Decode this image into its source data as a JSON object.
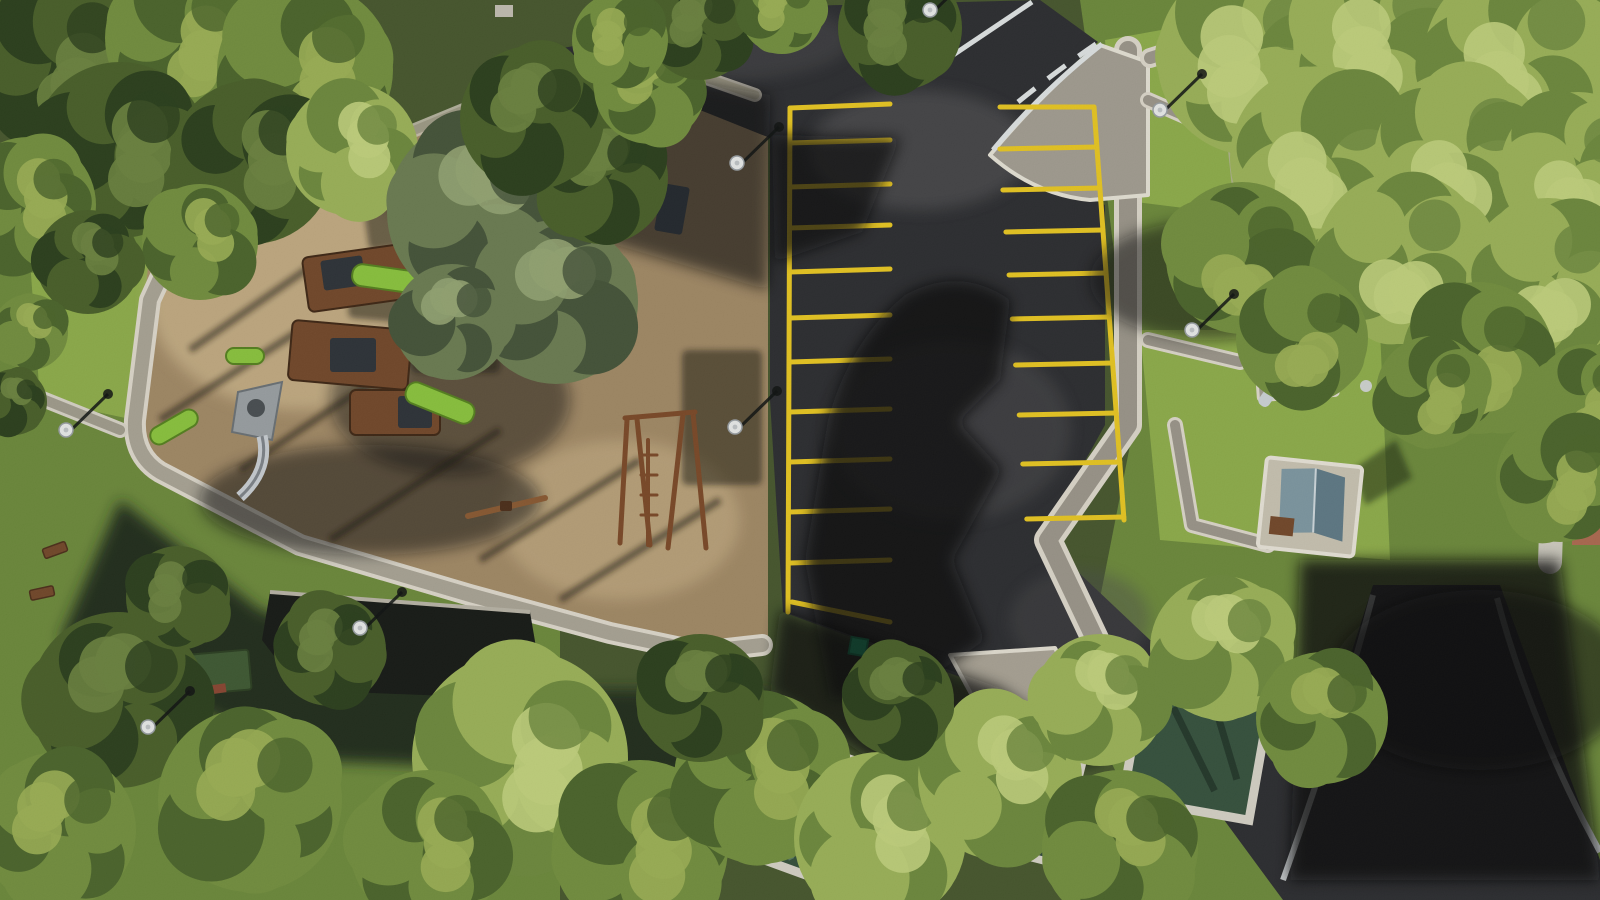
{
  "scene": {
    "kind": "aerial-drone-photograph",
    "subject": "public park seen from directly above: sandy playground with wooden play structures and swings on the left, freshly paved asphalt parking lot with yellow bay markings in the centre, lawns with paved white-edged walkways, picnic kiosks and covered sunken pools on the right and bottom, dense pine/cedar canopy all around",
    "lighting": "low sun from lower-left; long hard shadows point to the upper-right; large tree shadows fall across the parking lot"
  },
  "colors": {
    "sand": "#a28a66",
    "sand_light": "#c2ab82",
    "asphalt": "#2d2e31",
    "asphalt_light": "#4b4c4e",
    "grass": "#6d8a3c",
    "grass_bright": "#8fae4b",
    "grass_dark": "#3c5226",
    "path_gray": "#a59f90",
    "path_white": "#e6e2d6",
    "line_yellow": "#e9c722",
    "line_white": "#dfe3e4",
    "wood": "#74492a",
    "wood_dark": "#4d2f1a",
    "slide_green": "#8bc43e",
    "roof_blue": "#9db3bf",
    "roof_blue_dark": "#5f7a86",
    "shadow": "#0b0d10",
    "pool_cover": "#34503c",
    "pool_cover_light": "#7d98a2",
    "red_roof": "#ad6a50"
  },
  "parking_lot": {
    "surface": "new black asphalt",
    "left_column": {
      "spine": [
        790,
        108,
        788,
        612
      ],
      "tooth_end_x": 890,
      "tooth_ys": [
        143,
        187,
        228,
        272,
        318,
        362,
        412,
        462,
        512,
        563
      ],
      "top_line": [
        790,
        108,
        890,
        104
      ],
      "bottom_line": [
        792,
        602,
        890,
        622
      ],
      "bay_count": 10
    },
    "right_column": {
      "spine": [
        1094,
        107,
        1124,
        520
      ],
      "tooth_length": 97,
      "tooth_ys": [
        147,
        188,
        230,
        273,
        317,
        363,
        413,
        462,
        517
      ],
      "top_line": [
        1000,
        107,
        1094,
        107
      ],
      "bay_count": 9
    }
  },
  "trees": [
    {
      "x": 60,
      "y": 60,
      "r": 85,
      "tone": "dark"
    },
    {
      "x": 185,
      "y": 38,
      "r": 80,
      "tone": "mid"
    },
    {
      "x": 305,
      "y": 70,
      "r": 88,
      "tone": "mid"
    },
    {
      "x": 120,
      "y": 150,
      "r": 88,
      "tone": "dark"
    },
    {
      "x": 252,
      "y": 162,
      "r": 82,
      "tone": "dark"
    },
    {
      "x": 28,
      "y": 205,
      "r": 68,
      "tone": "mid"
    },
    {
      "x": 352,
      "y": 150,
      "r": 66,
      "tone": "bright"
    },
    {
      "x": 200,
      "y": 242,
      "r": 58,
      "tone": "mid"
    },
    {
      "x": 88,
      "y": 262,
      "r": 52,
      "tone": "dark"
    },
    {
      "x": 30,
      "y": 332,
      "r": 38,
      "tone": "mid"
    },
    {
      "x": 14,
      "y": 402,
      "r": 33,
      "tone": "dark"
    },
    {
      "x": 482,
      "y": 212,
      "r": 95,
      "tone": "cedar"
    },
    {
      "x": 556,
      "y": 302,
      "r": 82,
      "tone": "cedar"
    },
    {
      "x": 452,
      "y": 322,
      "r": 58,
      "tone": "cedar"
    },
    {
      "x": 602,
      "y": 178,
      "r": 66,
      "tone": "dark"
    },
    {
      "x": 532,
      "y": 118,
      "r": 72,
      "tone": "dark"
    },
    {
      "x": 650,
      "y": 88,
      "r": 56,
      "tone": "mid"
    },
    {
      "x": 700,
      "y": 28,
      "r": 52,
      "tone": "dark"
    },
    {
      "x": 782,
      "y": 12,
      "r": 42,
      "tone": "mid"
    },
    {
      "x": 620,
      "y": 40,
      "r": 48,
      "tone": "mid"
    },
    {
      "x": 900,
      "y": 28,
      "r": 62,
      "tone": "dark"
    },
    {
      "x": 1255,
      "y": 58,
      "r": 98,
      "tone": "bright"
    },
    {
      "x": 1385,
      "y": 40,
      "r": 92,
      "tone": "bright"
    },
    {
      "x": 1520,
      "y": 58,
      "r": 96,
      "tone": "bright"
    },
    {
      "x": 1322,
      "y": 158,
      "r": 92,
      "tone": "bright"
    },
    {
      "x": 1462,
      "y": 158,
      "r": 88,
      "tone": "bright"
    },
    {
      "x": 1578,
      "y": 170,
      "r": 78,
      "tone": "bright"
    },
    {
      "x": 1242,
      "y": 258,
      "r": 76,
      "tone": "mid"
    },
    {
      "x": 1402,
      "y": 258,
      "r": 86,
      "tone": "bright"
    },
    {
      "x": 1548,
      "y": 280,
      "r": 82,
      "tone": "bright"
    },
    {
      "x": 1302,
      "y": 338,
      "r": 66,
      "tone": "mid"
    },
    {
      "x": 1478,
      "y": 358,
      "r": 76,
      "tone": "mid"
    },
    {
      "x": 1588,
      "y": 400,
      "r": 56,
      "tone": "mid"
    },
    {
      "x": 1432,
      "y": 392,
      "r": 56,
      "tone": "mid"
    },
    {
      "x": 1560,
      "y": 478,
      "r": 64,
      "tone": "mid"
    },
    {
      "x": 520,
      "y": 758,
      "r": 108,
      "tone": "bright"
    },
    {
      "x": 640,
      "y": 848,
      "r": 88,
      "tone": "mid"
    },
    {
      "x": 428,
      "y": 848,
      "r": 78,
      "tone": "mid"
    },
    {
      "x": 760,
      "y": 778,
      "r": 86,
      "tone": "mid"
    },
    {
      "x": 880,
      "y": 838,
      "r": 86,
      "tone": "bright"
    },
    {
      "x": 1000,
      "y": 778,
      "r": 82,
      "tone": "bright"
    },
    {
      "x": 1120,
      "y": 848,
      "r": 78,
      "tone": "mid"
    },
    {
      "x": 1100,
      "y": 700,
      "r": 66,
      "tone": "bright"
    },
    {
      "x": 1222,
      "y": 648,
      "r": 72,
      "tone": "bright"
    },
    {
      "x": 1322,
      "y": 718,
      "r": 66,
      "tone": "mid"
    },
    {
      "x": 898,
      "y": 700,
      "r": 56,
      "tone": "dark"
    },
    {
      "x": 700,
      "y": 698,
      "r": 64,
      "tone": "dark"
    },
    {
      "x": 118,
      "y": 700,
      "r": 88,
      "tone": "dark"
    },
    {
      "x": 250,
      "y": 800,
      "r": 92,
      "tone": "mid"
    },
    {
      "x": 58,
      "y": 830,
      "r": 78,
      "tone": "mid"
    },
    {
      "x": 330,
      "y": 650,
      "r": 56,
      "tone": "dark"
    },
    {
      "x": 178,
      "y": 598,
      "r": 52,
      "tone": "dark"
    }
  ],
  "tree_tones": {
    "bright": [
      "#c2d17d",
      "#9cb359",
      "#6e8a3e"
    ],
    "mid": [
      "#9db155",
      "#74903f",
      "#4c662c"
    ],
    "dark": [
      "#6d8440",
      "#4a6029",
      "#2c401d"
    ],
    "cedar": [
      "#95a573",
      "#6c7d52",
      "#45543a"
    ]
  },
  "lamps": [
    {
      "x": 66,
      "y": 430
    },
    {
      "x": 737,
      "y": 163
    },
    {
      "x": 735,
      "y": 427
    },
    {
      "x": 360,
      "y": 628
    },
    {
      "x": 148,
      "y": 727
    },
    {
      "x": 1160,
      "y": 110
    },
    {
      "x": 1192,
      "y": 330
    },
    {
      "x": 930,
      "y": 10
    }
  ],
  "benches": [
    {
      "x": 55,
      "y": 550,
      "rot": -20
    },
    {
      "x": 42,
      "y": 593,
      "rot": -12
    },
    {
      "x": 168,
      "y": 605,
      "rot": 6
    }
  ],
  "pool_enclosures": [
    {
      "cx": 800,
      "cy": 807,
      "w": 124,
      "h": 124,
      "rot": 20,
      "cover": "dark-green"
    },
    {
      "cx": 1020,
      "cy": 798,
      "w": 104,
      "h": 110,
      "rot": 14,
      "cover": "light-tarp"
    },
    {
      "cx": 1196,
      "cy": 752,
      "w": 128,
      "h": 116,
      "rot": 10,
      "cover": "dark-green"
    }
  ],
  "kiosks": [
    {
      "name": "kiosk-blue-roof-north",
      "x": 1268,
      "y": 142
    },
    {
      "name": "picnic-shelter-northeast",
      "x": 1520,
      "y": 140
    },
    {
      "name": "picnic-table-east",
      "x": 1295,
      "y": 365
    },
    {
      "name": "kiosk-blue-roof-east",
      "x": 1310,
      "y": 505
    }
  ],
  "playground": {
    "ground": "tan sand",
    "equipment": [
      "wooden multi-tower play structure with green slides",
      "steel spiral slide on grey triangular platform",
      "double swing set",
      "see-saw",
      "climbing frame"
    ]
  }
}
